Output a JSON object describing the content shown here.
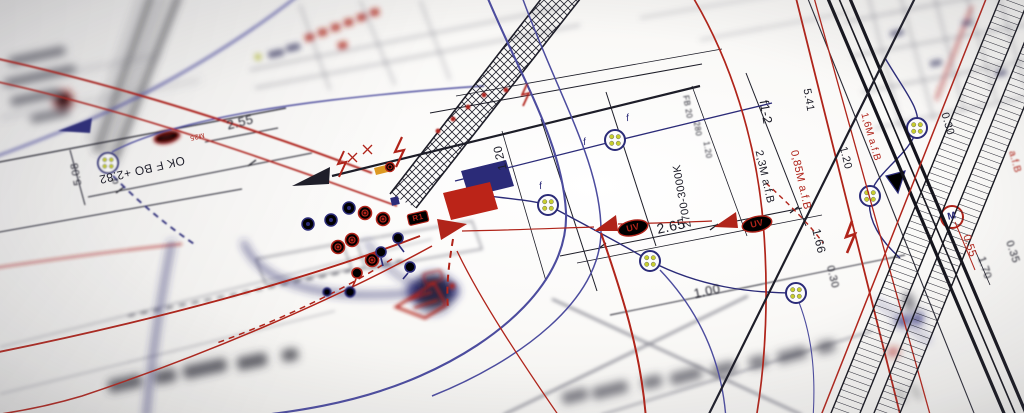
{
  "meta": {
    "description": "Angled photograph of a paper electrical wiring blueprint, sharp in the centre with blurred edges",
    "document_type": "electrical installation plan"
  },
  "colors": {
    "paper": "#f6f5f2",
    "ink": "#1d1d28",
    "red": "#b0241a",
    "navy": "#2b2b78",
    "violet": "#4c4c9e",
    "cable_dot_yellow": "#c8ce2d"
  },
  "labels": {
    "uv_marker": "UV",
    "dim_2_65": "2.65",
    "dim_1_00": "1.00",
    "dim_1_66": "1.66",
    "dim_0_30_a": "0.30",
    "dim_0_30_b": "0.30",
    "dim_0_55": "0.55",
    "dim_1_70": "1.70",
    "dim_0_35": "0.35",
    "dim_1_20_right": "1.20",
    "dim_1_20_center": "1.20",
    "fixture_f1_2": "f1-2",
    "dim_5_41": "5.41",
    "fb_20": "FB 20",
    "num_280": "280",
    "dim_1_20_small": "1.20",
    "color_temp": "2700-3000K",
    "cable_2_3m": "2,3M a.f.B",
    "cable_0_85m": "0,85M a.f.B",
    "cable_1_6m": "1,6M a.f.B",
    "cable_afb": "a.f.B",
    "dim_2_55": "2.55",
    "level_mark": "OK F BO +2.82",
    "conduit_m25": "M25",
    "dim_5_08": "5.08",
    "cable_d": "d",
    "relay_r1": "R1",
    "motor_m": "M",
    "phase_f": "f"
  },
  "symbols": {
    "cable_junction": "circle with four yellow conductor dots",
    "motor": "red circle with letter M",
    "uv_marker": "red oval with UV text and solid red arrow",
    "lightning": "red zigzag surge symbol",
    "socket_outlet": "red concentric circles",
    "luminaire": "navy keyhole circle with tail",
    "distribution_board_blue": "solid navy parallelogram",
    "distribution_board_red": "solid red parallelogram",
    "direction_arrow": "solid black triangle"
  }
}
